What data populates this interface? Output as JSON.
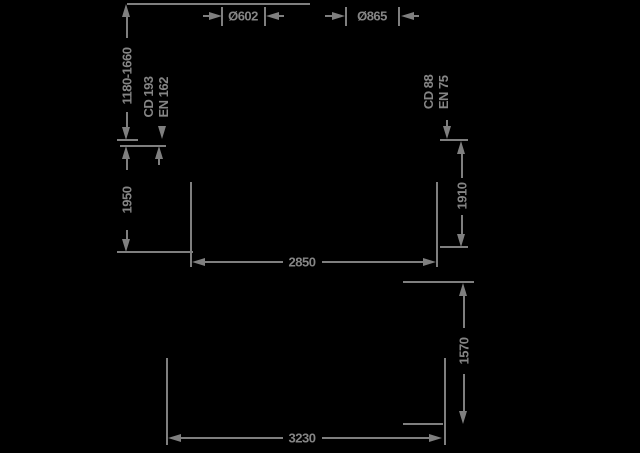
{
  "drawing": {
    "type": "engineering-dimension-drawing",
    "colors": {
      "background": "#000000",
      "line": "#7f7f7f",
      "text": "#858585"
    },
    "dimensions": {
      "dia_left": "Ø602",
      "dia_right": "Ø865",
      "height_range": "1180-1660",
      "height_left": "1950",
      "height_right": "1910",
      "width_inner": "2850",
      "height_lower": "1570",
      "width_outer": "3230",
      "left_block": {
        "line1": "CD 193",
        "line2": "EN 162"
      },
      "right_block": {
        "line1": "CD 88",
        "line2": "EN 75"
      }
    }
  }
}
